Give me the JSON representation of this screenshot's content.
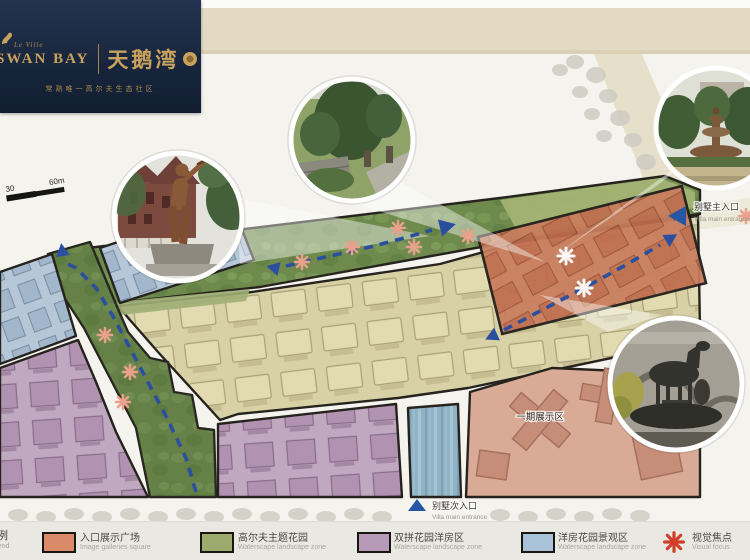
{
  "logo": {
    "brand_script": "Le Ville",
    "brand_en": "SWAN BAY",
    "brand_cn": "天鹅湾",
    "tagline": "常熟唯一高尔夫生态社区"
  },
  "scale_bar": {
    "start": "30",
    "end": "60m"
  },
  "map": {
    "main_entrance": {
      "cn": "别墅主入口",
      "en": "Villa main entrance"
    },
    "sub_entrance": {
      "cn": "别墅次入口",
      "en": "Villa main entrance"
    },
    "phase1_label": "一期展示区"
  },
  "legend": {
    "title_cn": "图例",
    "title_en": "Legend",
    "items": [
      {
        "swatch": "#d98a68",
        "cn": "入口展示广场",
        "en": "Image galleries square"
      },
      {
        "swatch": "#9cab6d",
        "cn": "高尔夫主题花园",
        "en": "Waterscape landscape zone"
      },
      {
        "swatch": "#b79ab7",
        "cn": "双拼花园洋房区",
        "en": "Waterscape landscape zone"
      },
      {
        "swatch": "#a9c2d8",
        "cn": "洋房花园景观区",
        "en": "Waterscape landscape zone"
      },
      {
        "symbol": "asterisk",
        "color": "#d13f2b",
        "cn": "视觉焦点",
        "en": "Visual focus"
      }
    ]
  },
  "colors": {
    "logo_bg": "#1c2b40",
    "gold": "#c9a25e",
    "arrow_blue": "#2b4f9e",
    "focus_pink": "#e8a18c",
    "focus_red": "#d13f2b",
    "zone_entry": "#d98a68",
    "zone_golf": "#6e8a4c",
    "zone_duplex": "#c0a8c0",
    "zone_terrace": "#b6c7d8",
    "zone_water": "#8fb3c4",
    "zone_houses": "#d8d1a6",
    "zone_phase1": "#d9ab97"
  }
}
